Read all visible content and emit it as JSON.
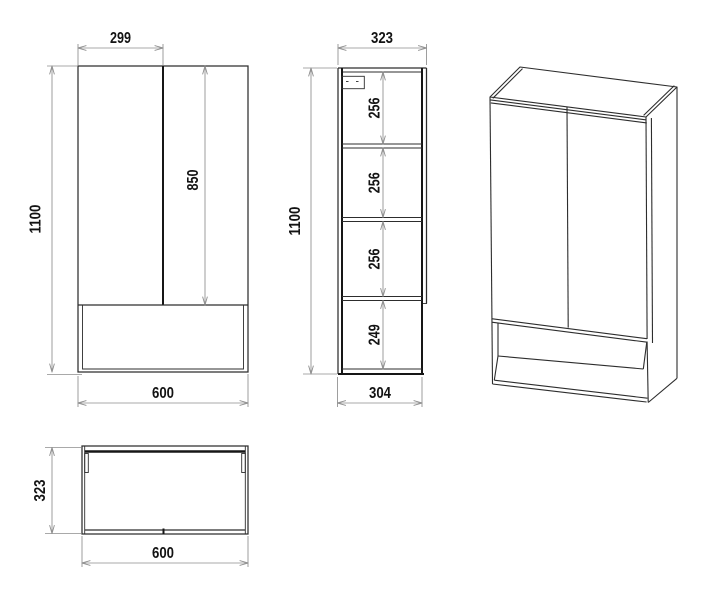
{
  "dims": {
    "front_door_width": "299",
    "front_door_height": "850",
    "front_height": "1100",
    "front_width": "600",
    "side_depth": "323",
    "side_section1": "256",
    "side_section2": "256",
    "side_section3": "256",
    "side_section4": "249",
    "side_height": "1100",
    "side_body_depth": "304",
    "plan_depth": "323",
    "plan_width": "600"
  },
  "colors": {
    "outline": "#2d2d2d",
    "heavy": "#161616",
    "dimline": "#8d8d8d",
    "dimtext": "#131313",
    "background": "#ffffff"
  }
}
